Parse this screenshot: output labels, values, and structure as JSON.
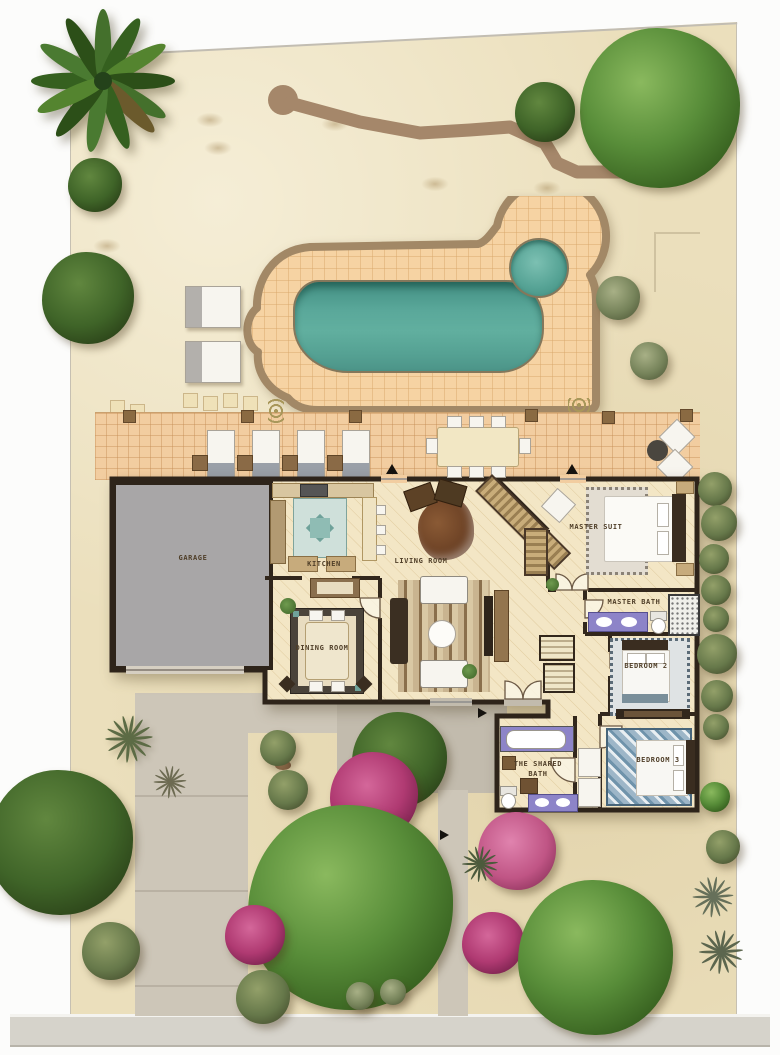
{
  "plan_title": "residential-site-plan",
  "rooms": {
    "garage": {
      "label": "GARAGE"
    },
    "kitchen": {
      "label": "KITCHEN"
    },
    "living_room": {
      "label": "LIVING ROOM"
    },
    "dining_room": {
      "label": "DINING ROOM"
    },
    "master_suite": {
      "label": "MASTER SUIT"
    },
    "master_bath": {
      "label": "MASTER BATH"
    },
    "bedroom_2": {
      "label": "BEDROOM 2"
    },
    "bedroom_3": {
      "label": "BEDROOM 3"
    },
    "shared_bath": {
      "line1": "THE SHARED",
      "line2": "BATH"
    }
  },
  "colors": {
    "sand": "#ebdfbc",
    "pool_water": "#58a79a",
    "deck_tile": "#f6d3a3",
    "patio_tile": "#f2cda0",
    "deck_border": "#a28866",
    "wall": "#2e241a",
    "garage_floor": "#a8a6a7",
    "driveway": "#cdc6b8",
    "courtyard": "#c2bbad",
    "foliage_green": "#4a7c31",
    "bougainvillea": "#b03a72",
    "bath_vanity_purple": "#8d84c8"
  }
}
